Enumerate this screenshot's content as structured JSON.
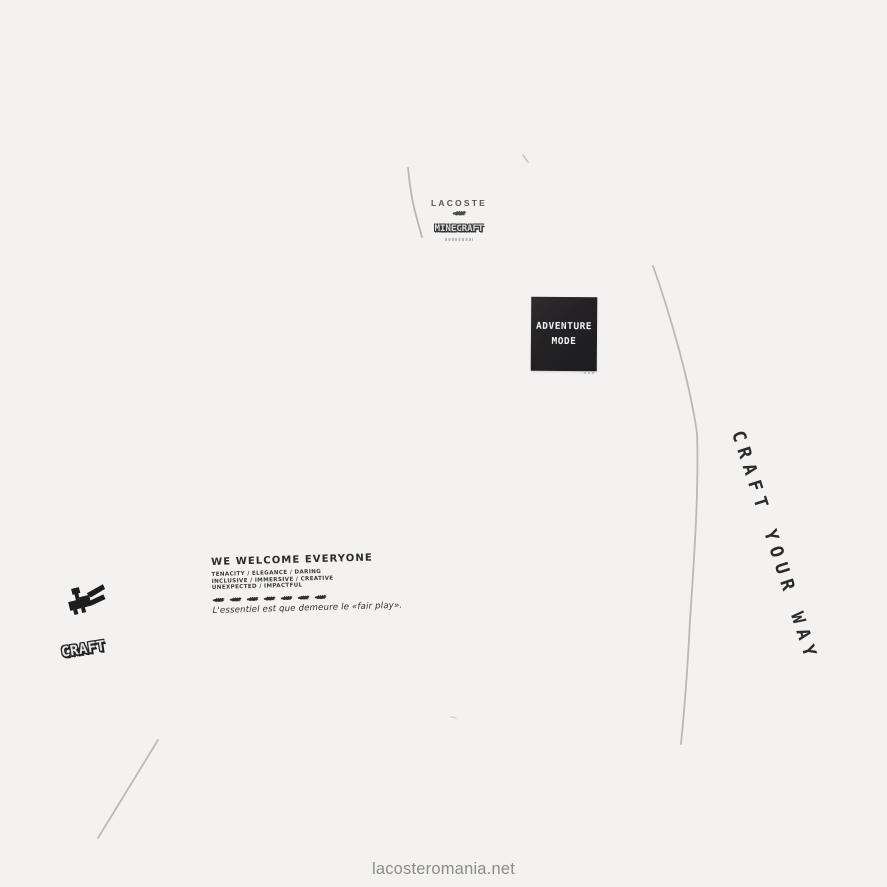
{
  "colors": {
    "background": "#f3f2f0",
    "seam": "#b4b4b4",
    "ink": "#2c2c2c",
    "patch_background": "#232124",
    "patch_text": "#f2f2f2",
    "watermark": "#8b8b8b"
  },
  "brand_block": {
    "lacoste_label": "LACOSTE",
    "minecraft_label": "MINECRAFT"
  },
  "patch": {
    "line1": "ADVENTURE",
    "line2": "MODE"
  },
  "right_slogan": {
    "text": "CRAFT YOUR WAY"
  },
  "chest_print": {
    "headline": "WE WELCOME EVERYONE",
    "value_lines": [
      "TENACITY / ELEGANCE / DARING",
      "INCLUSIVE / IMMERSIVE / CREATIVE",
      "UNEXPECTED / IMPACTFUL"
    ],
    "croc_icon_count": 7,
    "tagline": "L'essentiel est que demeure le «fair play»."
  },
  "sleeve_print": {
    "craft_label": "CRAFT"
  },
  "watermark": {
    "text": "lacosteromania.net"
  }
}
